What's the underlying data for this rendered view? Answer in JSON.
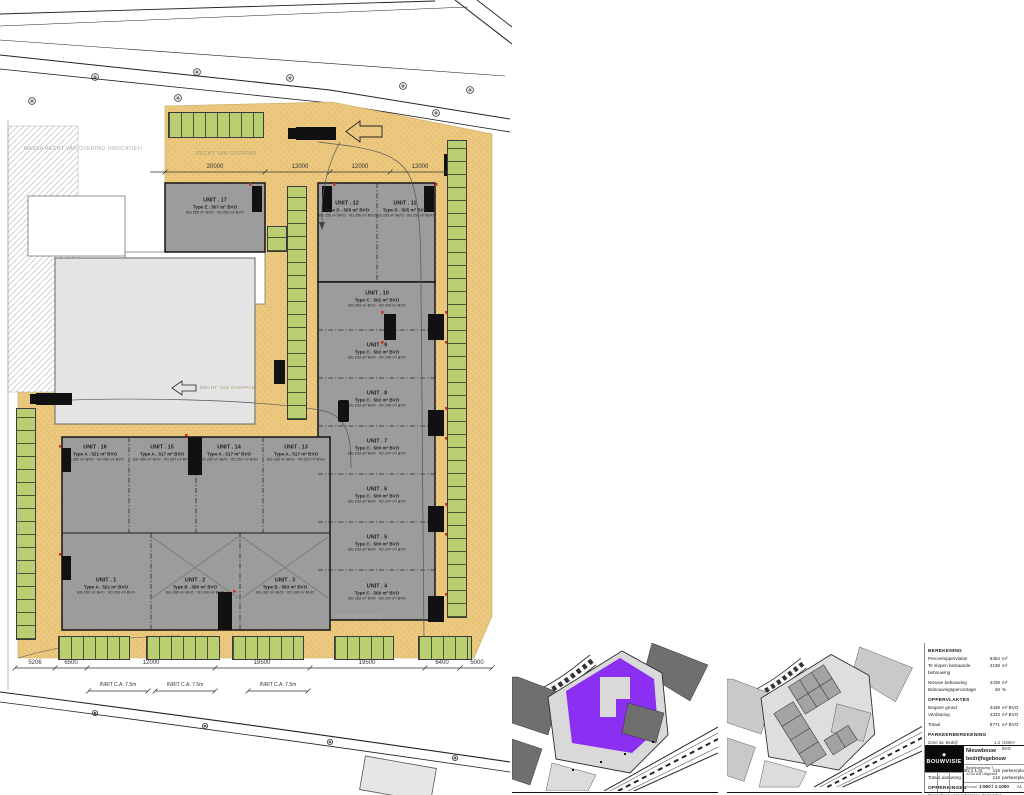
{
  "plan": {
    "labels": {
      "massa_overpad_top": "MASSA RECHT VAN OVERPAD (INDICATIEF)",
      "recht_van_overpad_top": "RECHT VAN OVERPAD",
      "recht_van_overpad_mid": "RECHT VAN OVERPAD",
      "massa_overpad_left": "MASSA RECHT VAN OVERPAD",
      "watermark": "www.bouwvisie.nl"
    },
    "units": [
      {
        "no": "UNIT . 1",
        "type": "Type A . 521 m² BVO",
        "bg": "BG  262 m² BVO",
        "vd": "VD  260 m² BVO"
      },
      {
        "no": "UNIT . 2",
        "type": "Type B . 580 m² BVO",
        "bg": "BG  390 m² BVO",
        "vd": "VD  190 m² BVO"
      },
      {
        "no": "UNIT . 3",
        "type": "Type B . 583 m² BVO",
        "bg": "BG  392 m² BVO",
        "vd": "VD  190 m² BVO"
      },
      {
        "no": "UNIT . 4",
        "type": "Type C . 500 m² BVO",
        "bg": "BG  253 m² BVO",
        "vd": "VD  247 m² BVO"
      },
      {
        "no": "UNIT . 5",
        "type": "Type C . 500 m² BVO",
        "bg": "BG  253 m² BVO",
        "vd": "VD  247 m² BVO"
      },
      {
        "no": "UNIT . 6",
        "type": "Type C . 500 m² BVO",
        "bg": "BG  253 m² BVO",
        "vd": "VD  247 m² BVO"
      },
      {
        "no": "UNIT . 7",
        "type": "Type C . 500 m² BVO",
        "bg": "BG  253 m² BVO",
        "vd": "VD  247 m² BVO"
      },
      {
        "no": "UNIT . 8",
        "type": "Type C . 502 m² BVO",
        "bg": "BG  253 m² BVO",
        "vd": "VD  249 m² BVO"
      },
      {
        "no": "UNIT . 9",
        "type": "Type C . 502 m² BVO",
        "bg": "BG  253 m² BVO",
        "vd": "VD  249 m² BVO"
      },
      {
        "no": "UNIT . 10",
        "type": "Type C . 502 m² BVO",
        "bg": "BG  253 m² BVO",
        "vd": "VD  249 m² BVO"
      },
      {
        "no": "UNIT . 11",
        "type": "Type D . 505 m² BVO",
        "bg": "BG  255 m² BVO",
        "vd": "VD  250 m² BVO"
      },
      {
        "no": "UNIT . 12",
        "type": "Type D . 505 m² BVO",
        "bg": "BG  255 m² BVO",
        "vd": "VD  250 m² BVO"
      },
      {
        "no": "UNIT . 13",
        "type": "Type A . 517 m² BVO",
        "bg": "BG  260 m² BVO",
        "vd": "VD  257 m² BVO"
      },
      {
        "no": "UNIT . 14",
        "type": "Type A . 517 m² BVO",
        "bg": "BG  260 m² BVO",
        "vd": "VD  257 m² BVO"
      },
      {
        "no": "UNIT . 15",
        "type": "Type A . 517 m² BVO",
        "bg": "BG  260 m² BVO",
        "vd": "VD  257 m² BVO"
      },
      {
        "no": "UNIT . 16",
        "type": "Type A . 521 m² BVO",
        "bg": "BG  262 m² BVO",
        "vd": "VD  260 m² BVO"
      },
      {
        "no": "UNIT . 17",
        "type": "Type E . 507 m² BVO",
        "bg": "BG  255 m² BVO",
        "vd": "VD  252 m² BVO"
      }
    ],
    "dims_top": [
      "20000",
      "12000",
      "12000",
      "12000"
    ],
    "dims_bottom": [
      "5206",
      "6500",
      "12000",
      "19500",
      "19500",
      "6400",
      "5000"
    ],
    "inrit_label": "INRIT C.A. 7.5m"
  },
  "colors": {
    "paving": "#EBC87E",
    "parking_green": "#B9CF72",
    "building_gray": "#9C9C9C",
    "existing_gray": "#E4E4E4",
    "highlight_purple": "#8B2FF2"
  },
  "titleblock": {
    "berekening": {
      "heading": "BEREKENING",
      "rows": [
        {
          "label": "Perceeloppervlakte",
          "value": "9354",
          "unit": "m²"
        },
        {
          "label": "Te slopen bestaande bebouwing",
          "value": "4138",
          "unit": "m²"
        },
        {
          "label": "Nieuwe bebouwing",
          "value": "4439",
          "unit": "m²"
        },
        {
          "label": "Bebouwingspercentage",
          "value": "48",
          "unit": "%"
        }
      ]
    },
    "oppervlaktes": {
      "heading": "OPPERVLAKTES",
      "rows": [
        {
          "label": "Begane grond",
          "value": "4439",
          "unit": "m² BVO"
        },
        {
          "label": "Verdieping",
          "value": "4333",
          "unit": "m² BVO"
        },
        {
          "label": "Totaal",
          "value": "8771",
          "unit": "m² BVO"
        }
      ]
    },
    "parkeer": {
      "heading": "PARKEERBEREKENING",
      "zone_label": "Zone 4a: Bedrijf arbeidsextensief / bezoekersextensief",
      "zone_value": "1.3",
      "zone_unit": "/100m² BVO",
      "norm_label": "Parkeernorm",
      "rows": [
        {
          "label": "Totaal benodigd (BN x 1.3)",
          "value": "116",
          "unit": "parkeerplaatsen"
        },
        {
          "label": "Totaal aanwezig",
          "value": "116",
          "unit": "parkeerplaatsen"
        }
      ]
    },
    "opmerking": {
      "heading": "OPMERKINGEN",
      "text": "Dient alleen voor indicatieve doeleinden"
    },
    "stamp": {
      "logo_mark": "◆",
      "logo_text": "BOUWVISIE",
      "project": "Nieuwbouw bedrijfsgebouw",
      "address1": "Bedrijvenweg 7",
      "address2": "1234 AB Uitgeest",
      "schaal_label": "Schaal",
      "schaal_value": "1:500 / 1:1000",
      "sheet_format": "A1"
    }
  }
}
